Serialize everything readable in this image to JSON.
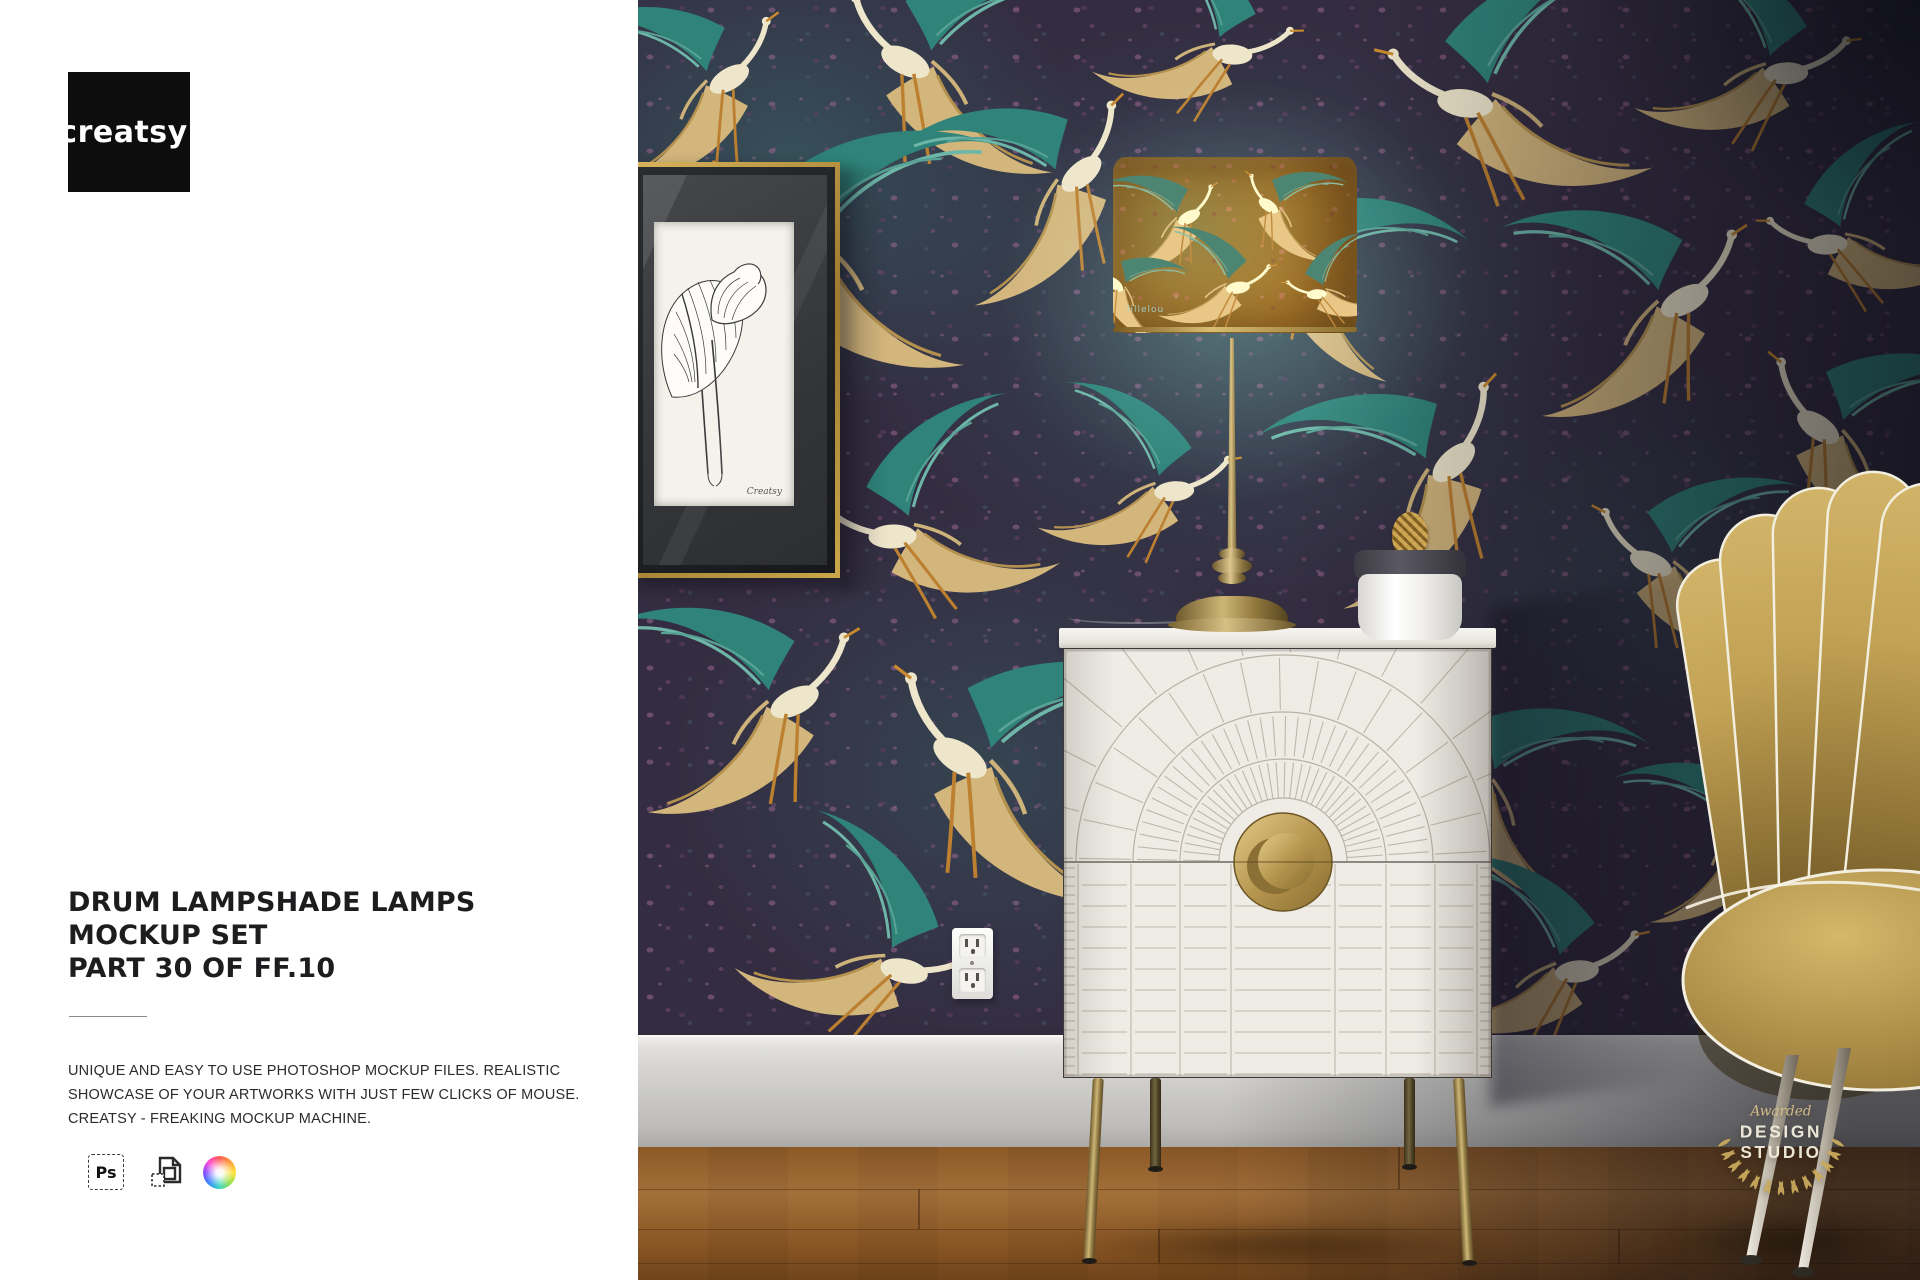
{
  "logo": {
    "text": "creatsy",
    "tm": "™"
  },
  "panel": {
    "title_lines": [
      "DRUM LAMPSHADE LAMPS",
      "MOCKUP SET",
      "PART 30 OF FF.10"
    ],
    "description_lines": [
      "UNIQUE AND EASY TO USE PHOTOSHOP MOCKUP FILES. REALISTIC",
      "SHOWCASE OF YOUR ARTWORKS WITH JUST FEW CLICKS OF MOUSE.",
      "CREATSY - FREAKING MOCKUP MACHINE."
    ],
    "tool_icons": [
      {
        "name": "photoshop-file-icon",
        "label": "Ps"
      },
      {
        "name": "smart-object-icon"
      },
      {
        "name": "color-wheel-icon"
      }
    ]
  },
  "scene": {
    "award_badge": {
      "script_word": "Awarded",
      "word1": "DESIGN",
      "word2": "STUDIO"
    },
    "frame_print_signature": "Creatsy",
    "lampshade_mark": "lillelou"
  },
  "colors": {
    "logo_bg": "#0d0d0d",
    "panel_bg": "#ffffff",
    "title_text": "#1d1d1f",
    "wallpaper_base": "#342d41",
    "wallpaper_teal": "#2f8379",
    "wallpaper_tan": "#d3b67c",
    "lampshade_ochre": "#b5812f",
    "brass": "#a98c4b",
    "cabinet_white": "#efece6",
    "chair_gold": "#c0a050",
    "floor_wood": "#96622e",
    "badge_gold": "#c9a95c"
  }
}
